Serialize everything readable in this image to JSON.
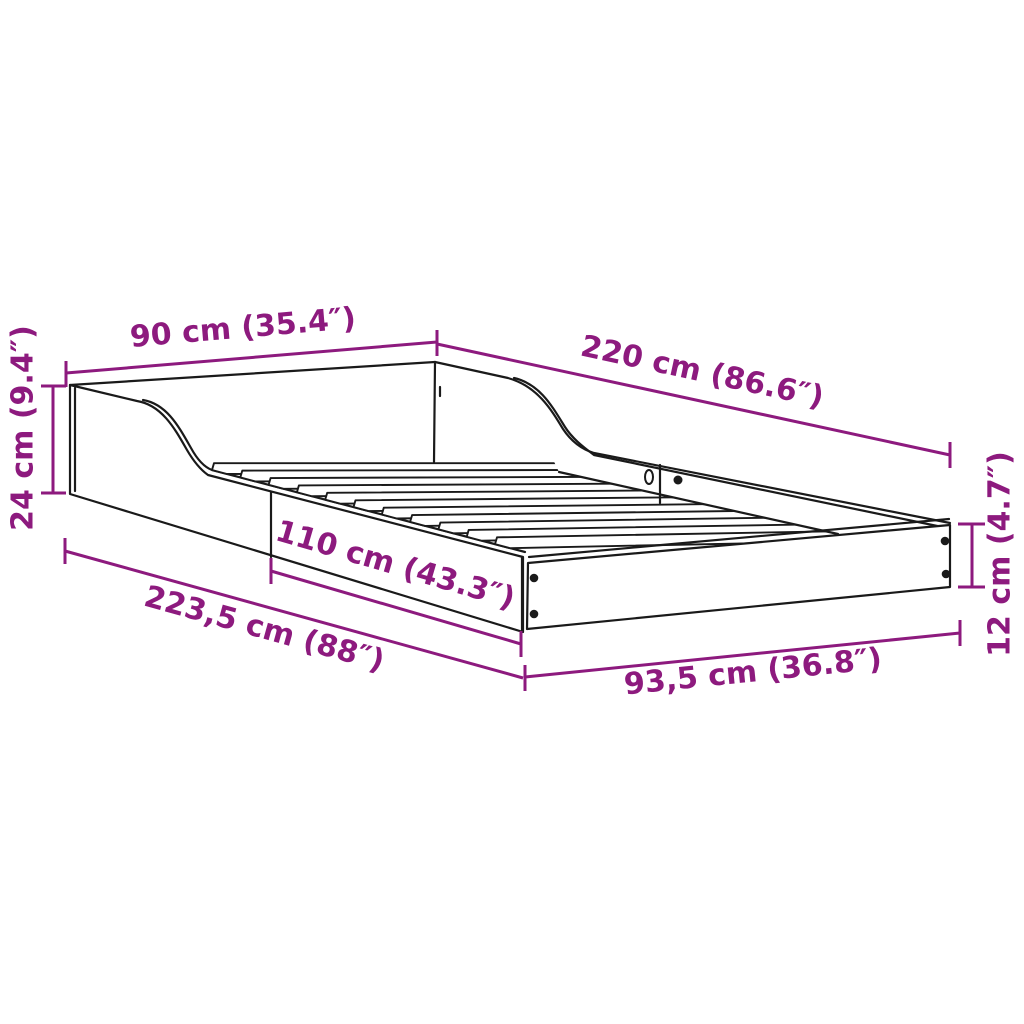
{
  "diagram": {
    "type": "product-dimension-diagram",
    "subject": "bed-frame-with-curved-headboard-and-slats",
    "background_color": "#ffffff",
    "line_color": "#1a1a1a",
    "accent_color": "#8d1a7e",
    "slat_count": 11,
    "dimensions": {
      "headboard_height": {
        "label": "24 cm (9.4″)"
      },
      "head_end_width": {
        "label": "90 cm (35.4″)"
      },
      "length_back": {
        "label": "220 cm (86.6″)"
      },
      "side_rail_length": {
        "label": "110 cm (43.3″)"
      },
      "length_front": {
        "label": "223,5 cm (88″)"
      },
      "foot_end_width": {
        "label": "93,5 cm (36.8″)"
      },
      "foot_rail_height": {
        "label": "12 cm (4.7″)"
      }
    }
  }
}
